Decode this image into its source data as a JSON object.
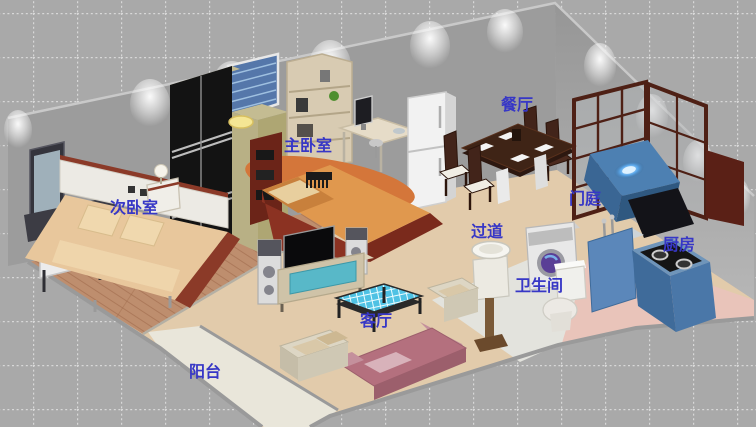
{
  "scene": {
    "description": "3D isometric cutaway rendering of an apartment with labeled rooms",
    "background": {
      "color": "#a9a9a9",
      "grid_line_color": "#d8d8d8",
      "grid_cell_px": 44
    }
  },
  "labels": {
    "room_label_color": "#3737c6",
    "rooms": [
      {
        "id": "secondary-bedroom",
        "label": "次卧室"
      },
      {
        "id": "master-bedroom",
        "label": "主卧室"
      },
      {
        "id": "dining-room",
        "label": "餐厅"
      },
      {
        "id": "entrance-hall",
        "label": "门庭"
      },
      {
        "id": "kitchen",
        "label": "厨房"
      },
      {
        "id": "hallway",
        "label": "过道"
      },
      {
        "id": "bathroom",
        "label": "卫生间"
      },
      {
        "id": "living-room",
        "label": "客厅"
      },
      {
        "id": "balcony",
        "label": "阳台"
      }
    ]
  },
  "palette": {
    "wall_gray": "#9c9c9c",
    "floor_tan": "#e2cbab",
    "floor_wood": "#be8e6e",
    "floor_balcony": "#e9e6da",
    "floor_bathroom": "#e3e3dd",
    "floor_kitchen_pink": "#e9c4ba",
    "counter_blue": "#5b87ba",
    "sofa_pink": "#b4707e",
    "bed_orange": "#e0984e",
    "screen_wood_maroon": "#4e2015",
    "label_blue": "#3737c6"
  },
  "furniture": [
    "dresser-vanity",
    "bed-secondary",
    "bedside-table",
    "table-lamp",
    "wardrobe",
    "ceiling-lamp",
    "window-curtain",
    "bookshelf-master",
    "computer-desk",
    "desk-stool",
    "rug-orange",
    "bed-master",
    "refrigerator",
    "dining-table",
    "dining-chairs",
    "entry-screen",
    "entry-console",
    "cabinet-maroon",
    "tv-speakers",
    "television",
    "tv-cabinet",
    "coffee-table",
    "sofa-pink",
    "sofa-cream",
    "armchair",
    "washing-machine",
    "basin-stand",
    "toilet",
    "kitchen-counter"
  ]
}
